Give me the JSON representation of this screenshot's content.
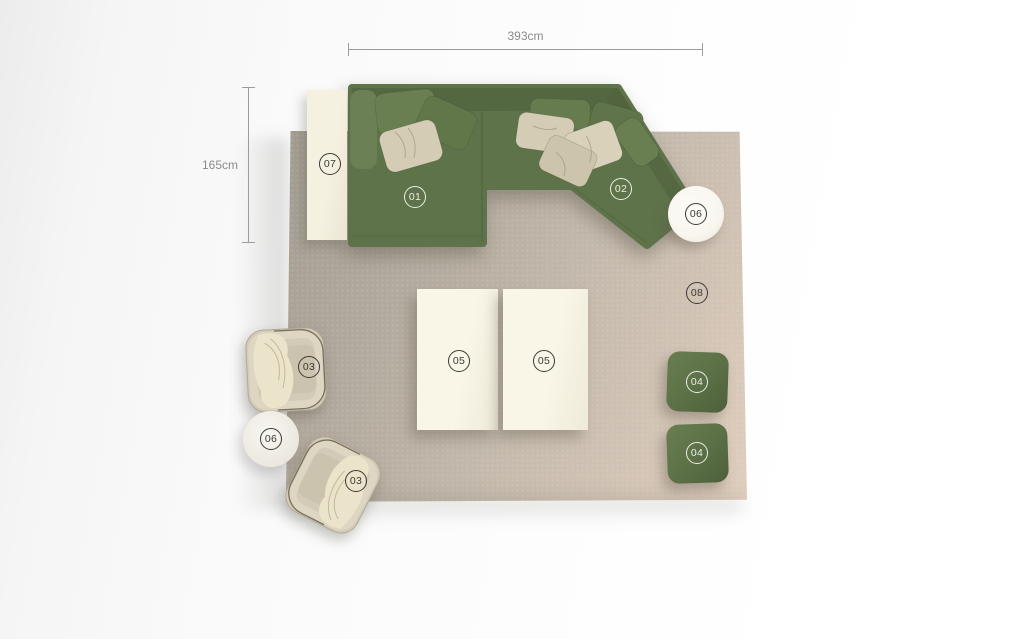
{
  "scene": {
    "dimensions": {
      "width": {
        "label": "393cm"
      },
      "height": {
        "label": "165cm"
      }
    },
    "markers": {
      "sofa_section_left": {
        "label": "01"
      },
      "sofa_section_right": {
        "label": "02"
      },
      "armchair_upper": {
        "label": "03"
      },
      "armchair_lower": {
        "label": "03"
      },
      "pouf_upper": {
        "label": "04"
      },
      "pouf_lower": {
        "label": "04"
      },
      "coffee_table_left": {
        "label": "05"
      },
      "coffee_table_right": {
        "label": "05"
      },
      "side_table_upper": {
        "label": "06"
      },
      "side_table_lower": {
        "label": "06"
      },
      "console": {
        "label": "07"
      },
      "rug": {
        "label": "08"
      }
    },
    "colors": {
      "sofa_green": "#5e734a",
      "sofa_green_dark": "#50633e",
      "sofa_green_light": "#6b8054",
      "pouf_green": "#5b7046",
      "pillow_cream": "#d5ccb6",
      "cream_furniture": "#f5f1e0",
      "armchair_cream": "#d3cbb8",
      "rug_dark": "#a39c92",
      "rug_mid": "#c2b8ab",
      "rug_light": "#e0cebd",
      "table_white": "#f8f6ef",
      "marker_dark": "#3a3936",
      "marker_light": "#edefe4",
      "dimension_line": "#9c9c9c",
      "dimension_text": "#8a8a8a"
    }
  }
}
